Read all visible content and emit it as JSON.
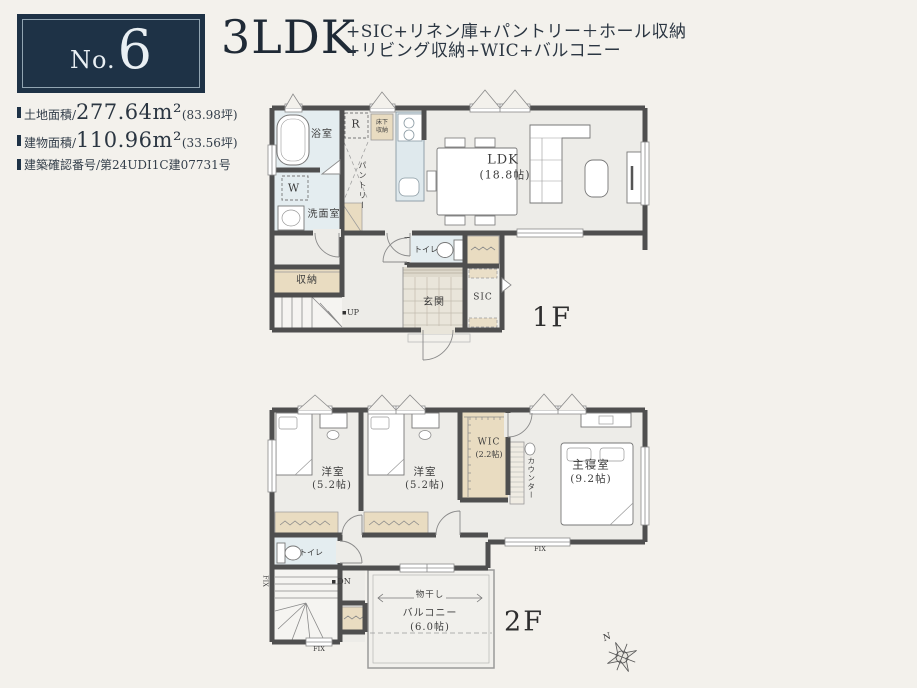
{
  "colors": {
    "accent_navy": "#1e3246",
    "wall": "#4f4f4f",
    "wet_area": "#e4edf0",
    "closet_beige": "#e9dcc1",
    "page_bg": "#f3f1ec"
  },
  "header": {
    "badge": {
      "prefix": "No.",
      "number": "6"
    },
    "title": "3LDK",
    "subtitle_line1": "+SIC+リネン庫+パントリー＋ホール収納",
    "subtitle_line2": "+リビング収納+WIC+バルコニー",
    "details": [
      {
        "label": "土地面積/",
        "value": "277.64",
        "unit": "m²",
        "note": "(83.98坪)"
      },
      {
        "label": "建物面積/",
        "value": "110.96",
        "unit": "m²",
        "note": "(33.56坪)"
      },
      {
        "label": "建築確認番号/",
        "value": "",
        "unit": "",
        "note": "第24UDI1C建07731号"
      }
    ]
  },
  "floor1": {
    "floor_label": "1F",
    "rooms": {
      "ldk": "LDK",
      "ldk_size": "(18.8帖)",
      "bath": "浴室",
      "washer": "W",
      "washroom": "洗面室",
      "fridge": "R",
      "underfloor_1": "床下",
      "underfloor_2": "収納",
      "pantry": "パントリー",
      "storage": "収納",
      "up": "UP",
      "toilet": "トイレ",
      "entrance": "玄関",
      "sic": "SIC"
    }
  },
  "floor2": {
    "floor_label": "2F",
    "compass_n": "N",
    "rooms": {
      "room1": "洋室",
      "room1_size": "(5.2帖)",
      "room2": "洋室",
      "room2_size": "(5.2帖)",
      "wic": "WIC",
      "wic_size": "(2.2帖)",
      "counter": "カウンター",
      "master": "主寝室",
      "master_size": "(9.2帖)",
      "toilet": "トイレ",
      "dn": "DN",
      "fix": "FIX",
      "monohoshi": "物干し",
      "balcony": "バルコニー",
      "balcony_size": "(6.0帖)"
    }
  }
}
